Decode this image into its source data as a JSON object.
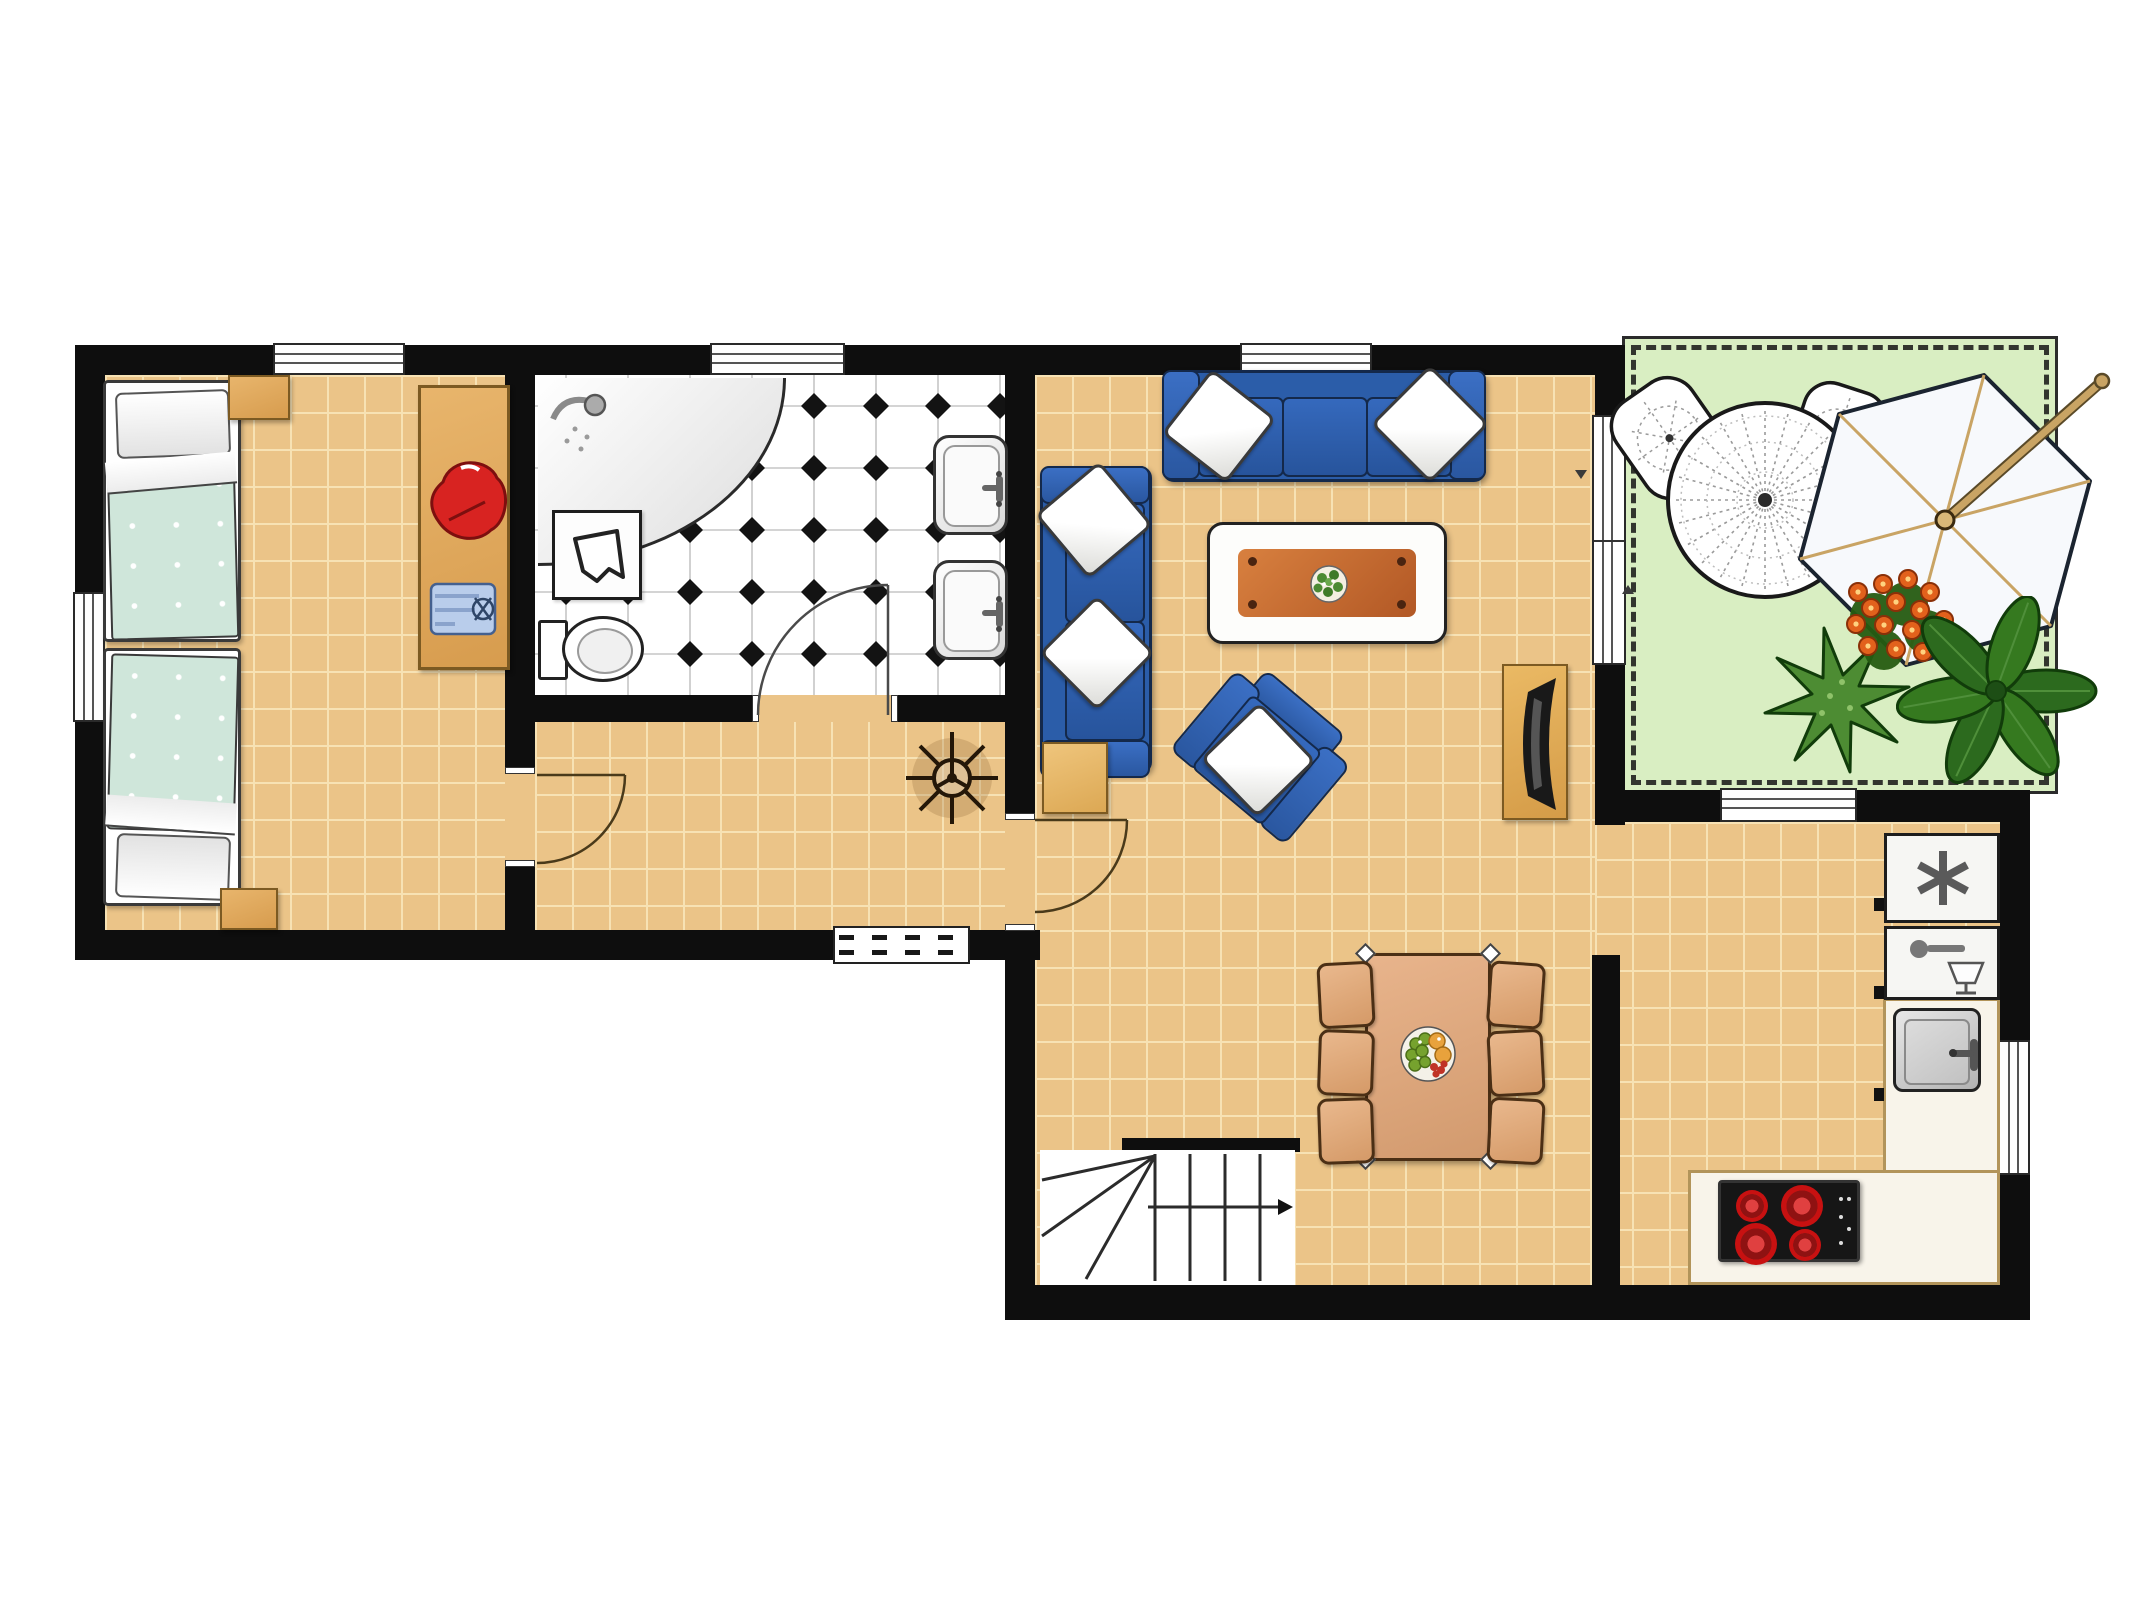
{
  "title": "apartment-floor-plan",
  "palette": {
    "wall": "#0e0e0e",
    "floor_wood": "#ebc488",
    "floor_grid": "#f7e2b4",
    "bath_tile": "#ffffff",
    "bath_grid": "#c6c6c6",
    "diamond": "#131313",
    "patio_green": "#d9eec2",
    "fence": "#2b2b2b",
    "sofa": "#2b5da9",
    "sofa_dark": "#14294b",
    "blanket_mint": "#cfe6da",
    "wood_tan": "#dfa95f",
    "wood_dark": "#7c5a22",
    "table_top1": "#d8803f",
    "table_top2": "#b25825",
    "dining_wood": "#e2ad80",
    "dining_dark": "#4b2f15",
    "counter": "#f8f4ea",
    "counter_edge": "#b2945a",
    "cooktop": "#161616",
    "burner": "#c81111",
    "red_cloth": "#d82321",
    "blue_cloth": "#b9cdeb",
    "agave": "#4d8c33",
    "leaf": "#2c6a1e",
    "leaf_dark": "#113c0a",
    "flower": "#e2611c",
    "lace": "#9a9a9a",
    "pole": "#c9a464"
  },
  "rooms": [
    {
      "id": "bedroom",
      "label": "bedroom",
      "floor": "wood"
    },
    {
      "id": "bathroom",
      "label": "bathroom",
      "floor": "checker-tile"
    },
    {
      "id": "hallway",
      "label": "hallway",
      "floor": "wood"
    },
    {
      "id": "living-room",
      "label": "living room",
      "floor": "wood"
    },
    {
      "id": "dining-kitchen",
      "label": "dining + kitchen",
      "floor": "wood"
    },
    {
      "id": "patio",
      "label": "patio",
      "floor": "grass"
    }
  ],
  "furniture": {
    "bedroom": [
      "single-bed-1",
      "single-bed-2",
      "nightstand-top",
      "nightstand-bottom",
      "dresser",
      "red-garment",
      "blue-shirt"
    ],
    "bathroom": [
      "corner-shower",
      "laundry-basket",
      "toilet",
      "washbasin-1",
      "washbasin-2"
    ],
    "hallway": [
      "ceiling-fan",
      "entrance-mat",
      "door-to-bedroom",
      "door-to-bathroom",
      "door-to-living-room"
    ],
    "living_room": [
      "three-seat-sofa",
      "two-seat-sofa",
      "side-table",
      "coffee-table",
      "armchair",
      "tv-stand",
      "sliding-door"
    ],
    "dining_kitchen": [
      "dining-table",
      "dining-chairs-x6",
      "fruit-bowl",
      "staircase",
      "freezer",
      "dishwasher",
      "kitchen-sink",
      "kitchen-counter",
      "cooktop"
    ],
    "patio": [
      "lace-table",
      "lace-chair-1",
      "lace-chair-2",
      "parasol",
      "agave-plant",
      "flowering-plant",
      "leafy-plant"
    ]
  },
  "windows": [
    "bedroom-top",
    "bedroom-left",
    "bathroom-top",
    "living-room-top",
    "kitchen-patio",
    "kitchen-right"
  ]
}
